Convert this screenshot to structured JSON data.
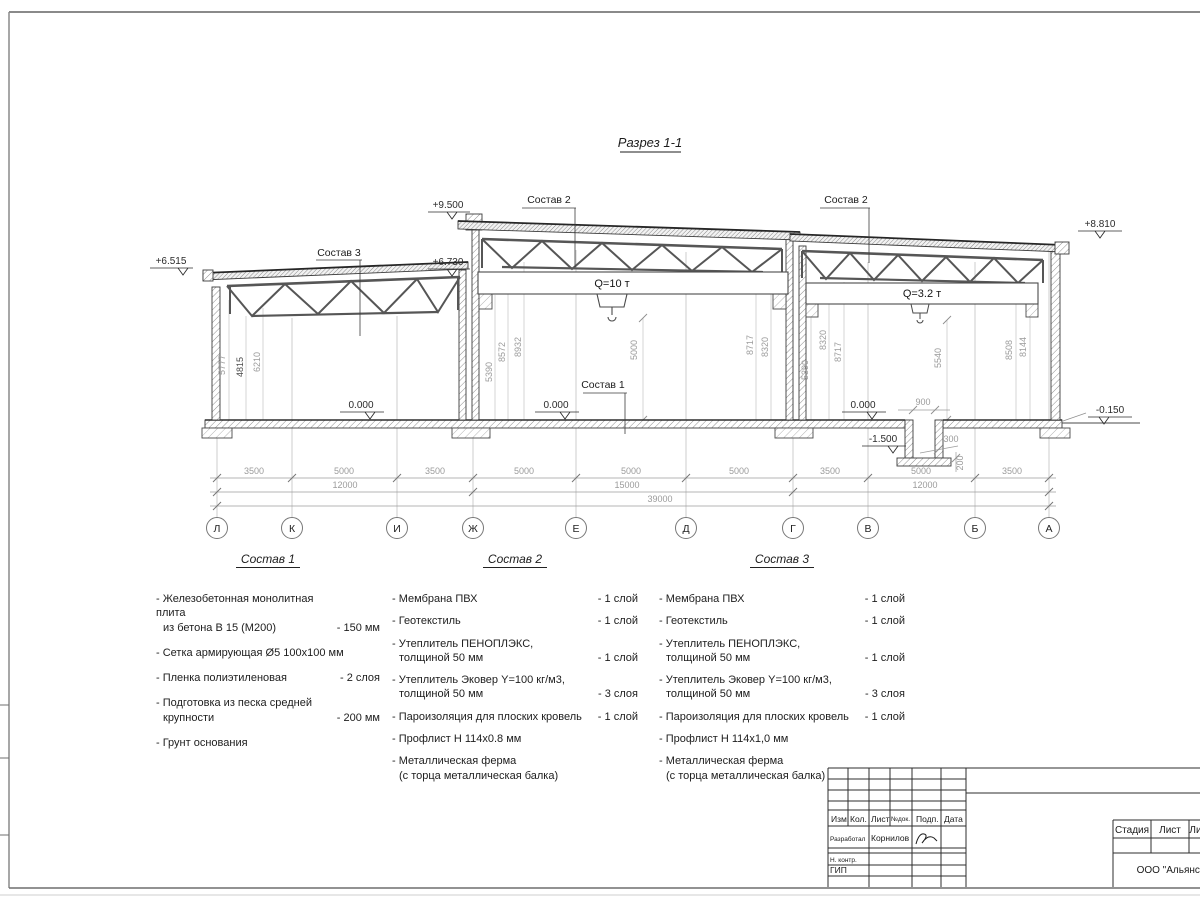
{
  "drawing_title": "Разрез 1-1",
  "section": {
    "elevations": {
      "left_eave": "+6.515",
      "mid_top": "+9.500",
      "left_roof": "+6.730",
      "right_top": "+8.810",
      "floor_zero": "0.000",
      "pit_bottom": "-1.500",
      "ground": "-0.150"
    },
    "leaders": {
      "sostav1": "Состав 1",
      "sostav2": "Состав 2",
      "sostav3": "Состав 3"
    },
    "cranes": {
      "main": "Q=10 т",
      "secondary": "Q=3.2 т"
    },
    "vertical_dims": [
      "5777",
      "4815",
      "6210",
      "5390",
      "8572",
      "8932",
      "5000",
      "8717",
      "8320",
      "5390",
      "8320",
      "8717",
      "5540",
      "8508",
      "8144"
    ],
    "pit_dims": {
      "width": "900",
      "ledge": "300",
      "slab": "200"
    },
    "dim_row_spans": [
      "3500",
      "5000",
      "3500",
      "5000",
      "5000",
      "5000",
      "3500",
      "5000",
      "3500"
    ],
    "dim_row_groups": [
      "12000",
      "15000",
      "12000"
    ],
    "dim_total": "39000",
    "axes": [
      "Л",
      "К",
      "И",
      "Ж",
      "Е",
      "Д",
      "Г",
      "В",
      "Б",
      "А"
    ]
  },
  "compositions": [
    {
      "title": "Состав 1",
      "items": [
        {
          "lines": [
            "- Железобетонная  монолитная плита",
            "из бетона В 15 (М200)"
          ],
          "qty": "- 150 мм"
        },
        {
          "lines": [
            "- Сетка армирующая Ø5 100х100 мм"
          ],
          "qty": ""
        },
        {
          "lines": [
            "- Пленка полиэтиленовая"
          ],
          "qty": "-  2 слоя"
        },
        {
          "lines": [
            "- Подготовка из песка средней",
            "крупности"
          ],
          "qty": "- 200 мм"
        },
        {
          "lines": [
            "- Грунт основания"
          ],
          "qty": ""
        }
      ]
    },
    {
      "title": "Состав 2",
      "items": [
        {
          "lines": [
            "- Мембрана ПВХ"
          ],
          "qty": "- 1 слой"
        },
        {
          "lines": [
            "- Геотекстиль"
          ],
          "qty": "- 1 слой"
        },
        {
          "lines": [
            "- Утеплитель ПЕНОПЛЭКС,",
            "толщиной 50 мм"
          ],
          "qty": "- 1 слой"
        },
        {
          "lines": [
            "- Утеплитель Эковер Y=100 кг/м3,",
            "толщиной 50 мм"
          ],
          "qty": "- 3 слоя"
        },
        {
          "lines": [
            "- Пароизоляция для плоских кровель"
          ],
          "qty": "- 1 слой"
        },
        {
          "lines": [
            "- Профлист Н 114х0.8 мм"
          ],
          "qty": ""
        },
        {
          "lines": [
            "- Металлическая ферма",
            "(с торца металлическая балка)"
          ],
          "qty": ""
        }
      ]
    },
    {
      "title": "Состав 3",
      "items": [
        {
          "lines": [
            "- Мембрана ПВХ"
          ],
          "qty": "- 1 слой"
        },
        {
          "lines": [
            "- Геотекстиль"
          ],
          "qty": "- 1 слой"
        },
        {
          "lines": [
            "- Утеплитель ПЕНОПЛЭКС,",
            "толщиной 50 мм"
          ],
          "qty": "- 1 слой"
        },
        {
          "lines": [
            "- Утеплитель Эковер Y=100 кг/м3,",
            "толщиной 50 мм"
          ],
          "qty": "- 3 слоя"
        },
        {
          "lines": [
            "- Пароизоляция для плоских кровель"
          ],
          "qty": "- 1 слой"
        },
        {
          "lines": [
            "- Профлист Н 114х1,0 мм"
          ],
          "qty": ""
        },
        {
          "lines": [
            "- Металлическая ферма",
            "(с торца металлическая балка)"
          ],
          "qty": ""
        }
      ]
    }
  ],
  "titleblock": {
    "columns": [
      "Изм.",
      "Кол.",
      "Лист",
      "№док.",
      "Подп.",
      "Дата"
    ],
    "rows": {
      "developed_label": "Разработал",
      "developed_name": "Корнилов",
      "ncontr_label": "Н. контр.",
      "gip_label": "ГИП"
    },
    "stage_header": [
      "Стадия",
      "Лист",
      "Лис"
    ],
    "company": "ООО \"Альянс\""
  }
}
